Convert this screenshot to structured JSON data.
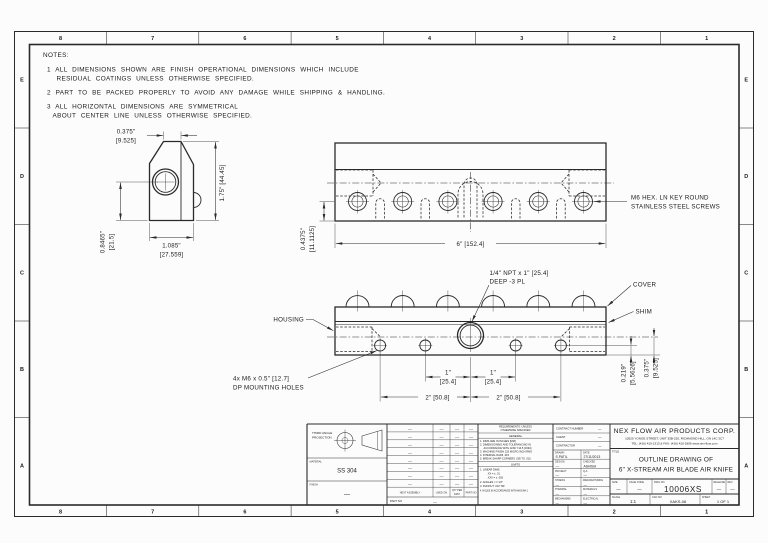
{
  "zones": {
    "cols": [
      "8",
      "7",
      "6",
      "5",
      "4",
      "3",
      "2",
      "1"
    ],
    "rows": [
      "E",
      "D",
      "C",
      "B",
      "A"
    ]
  },
  "notes": {
    "heading": "NOTES:",
    "n1a": "1   ALL DIMENSIONS SHOWN ARE FINISH OPERATIONAL DIMENSIONS WHICH INCLUDE",
    "n1b": "RESIDUAL COATINGS UNLESS OTHERWISE SPECIFIED.",
    "n2": "2   PART TO BE PACKED PROPERLY TO AVOID ANY DAMAGE WHILE SHIPPING & HANDLING.",
    "n3a": "3   ALL HORIZONTAL DIMENSIONS ARE SYMMETRICAL",
    "n3b": "ABOUT CENTER LINE UNLESS OTHERWISE SPECIFIED."
  },
  "side_view": {
    "dim_top": "0.375\"",
    "dim_top_mm": "[9.525]",
    "dim_height": "1.75\" [44.45]",
    "dim_left": "0.8465\"",
    "dim_left_mm": "[21.5]",
    "dim_bottom": "1.085\"",
    "dim_bottom_mm": "[27.559]"
  },
  "top_view": {
    "dim_width": "6\" [152.4]",
    "dim_offset": "0.4375\"",
    "dim_offset_mm": "[11.1125]",
    "screw_note_1": "M6 HEX. LN KEY ROUND",
    "screw_note_2": "STAINLESS STEEL SCREWS"
  },
  "front_view": {
    "npt_note_1": "1/4\" NPT x 1\" [25.4]",
    "npt_note_2": "DEEP -3 PL",
    "label_cover": "COVER",
    "label_shim": "SHIM",
    "label_housing": "HOUSING",
    "mount_note_1": "4x M6 x 0.5\" [12.7]",
    "mount_note_2": "DP MOUNTING HOLES",
    "dim_one": "1\"",
    "dim_one_mm": "[25.4]",
    "dim_two": "2\" [50.8]",
    "dim_a": "0.219\"",
    "dim_a_mm": "[5.5626]",
    "dim_b": "0.375\"",
    "dim_b_mm": "[9.525]"
  },
  "title_block": {
    "projection": {
      "l1": "THIRD ANGLE",
      "l2": "PROJECTION"
    },
    "material": {
      "label": "MATERIAL",
      "value": "SS 304"
    },
    "finish": {
      "label": "FINISH",
      "value": "—"
    },
    "application": {
      "col1": "NEXT ASSEMBLY",
      "col2": "USED ON",
      "col3a": "QTY PER",
      "col3b": "ASSY",
      "col4": "PART NO",
      "part_no_label": "PART NO",
      "dash": "—"
    },
    "requirements": {
      "h1": "REQUIREMENTS: UNLESS",
      "h2": "OTHERWISE SPECIFIED",
      "general": "GENERAL",
      "g1": "1. DIMS ARE IN INCHES [MM]",
      "g2": "2. DIMENSIONING AND TOLERANCING IN",
      "g2b": "ACCORDANCE WITH ANSI Y14.5 [1994]",
      "g3": "3. MACHINE FINISH 125 MICRO INCH RMS",
      "g4": "4. INTERNAL RADII .015",
      "g5": "5. BREAK SHARP CORNERS .005 TO .015",
      "limits": "LIMITS",
      "l1": "1. LINEAR DIMS.",
      "l1a": ".XX  = ± .01",
      "l1b": ".XXX = ± .005",
      "l2": "2. ANGLES = ± 1/2°",
      "l3": "3. RUNOUT .010 TIR",
      "l4": "4. HOLES IN ACCORDANCE WITH ANSI B4.1"
    },
    "contract": {
      "label1": "CONTRACT NUMBER",
      "label2": "CLIENT",
      "label3": "CONTRACTOR",
      "dash": "—"
    },
    "people": {
      "drawn_label": "DRAWN",
      "drawn": "S.PATIL",
      "date_label": "DATE",
      "date": "27/11/2013",
      "design_label": "DESIGN",
      "checked_label": "CHECKED",
      "checked": "ASHISH",
      "project_label": "PROJECT",
      "qa_label": "Q.A.",
      "stress_label": "STRESS",
      "mfg_label": "MANUFACTURING",
      "thermal_label": "THERMAL",
      "materials_label": "MATERIALS",
      "mech_label": "MECHANISMS",
      "elec_label": "ELECTRICAL",
      "dash": "—"
    },
    "company": {
      "name": "NEX FLOW AIR PRODUCTS CORP.",
      "address": "10520 YONGE STREET, UNIT 35B-220, RICHMOND HILL, ON L4C 3C7",
      "tel": "TEL: (416) 410-1313 & FAX: (416) 410-1806   www.nex-flow.com"
    },
    "title": {
      "label": "TITLE",
      "line1": "OUTLINE DRAWING OF",
      "line2": "6\" X-STREAM AIR BLADE AIR KNIFE"
    },
    "size_row": {
      "size_label": "SIZE",
      "size": "—",
      "cage_label": "CAGE CODE",
      "cage": "—",
      "dwg_label": "DWG NO",
      "dwg": "10006XS",
      "release_label": "RELEASE",
      "release": "—",
      "rev_label": "REV",
      "rev": "—"
    },
    "scale_row": {
      "scale_label": "SCALE",
      "scale": "1:1",
      "cad_label": "CAD NO",
      "cad": "XAKS-06",
      "sheet_label": "SHEET",
      "sheet": "1 OF 1"
    }
  }
}
